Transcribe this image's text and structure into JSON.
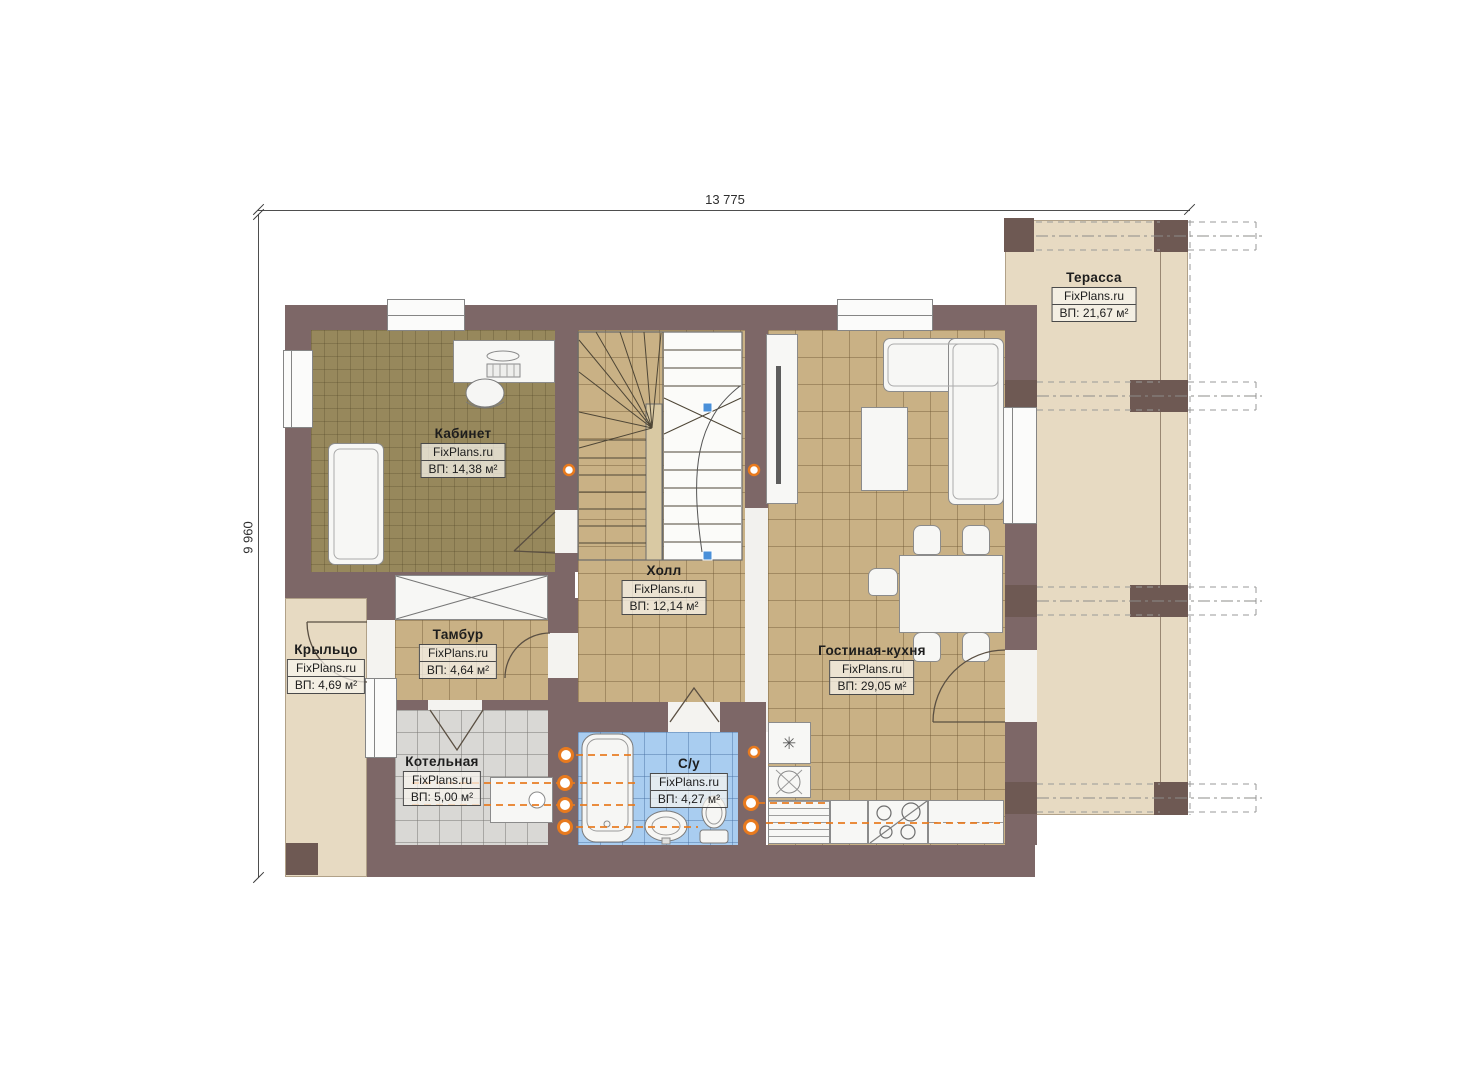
{
  "plan": {
    "brand": "FixPlans.ru",
    "dimensions": {
      "width_label": "13 775",
      "height_label": "9 960"
    },
    "rooms": [
      {
        "name": "Кабинет",
        "area": "ВП: 14,38 м²"
      },
      {
        "name": "Холл",
        "area": "ВП: 12,14 м²"
      },
      {
        "name": "Тамбур",
        "area": "ВП: 4,64 м²"
      },
      {
        "name": "Крыльцо",
        "area": "ВП: 4,69 м²"
      },
      {
        "name": "Котельная",
        "area": "ВП: 5,00 м²"
      },
      {
        "name": "С/у",
        "area": "ВП: 4,27 м²"
      },
      {
        "name": "Гостиная-кухня",
        "area": "ВП: 29,05 м²"
      },
      {
        "name": "Терасса",
        "area": "ВП: 21,67 м²"
      }
    ],
    "icons": {
      "fridge": "✳"
    },
    "colors": {
      "wall": "#7d6767",
      "column": "#6e5953",
      "tile_tan": "#c9b185",
      "tile_gray": "#d9d8d5",
      "tile_blue": "#a9cdf0",
      "office_floor": "#97885c",
      "outdoor": "#e7dac2",
      "accent_orange": "#e87a1e",
      "marker_blue": "#4a90d9"
    }
  }
}
